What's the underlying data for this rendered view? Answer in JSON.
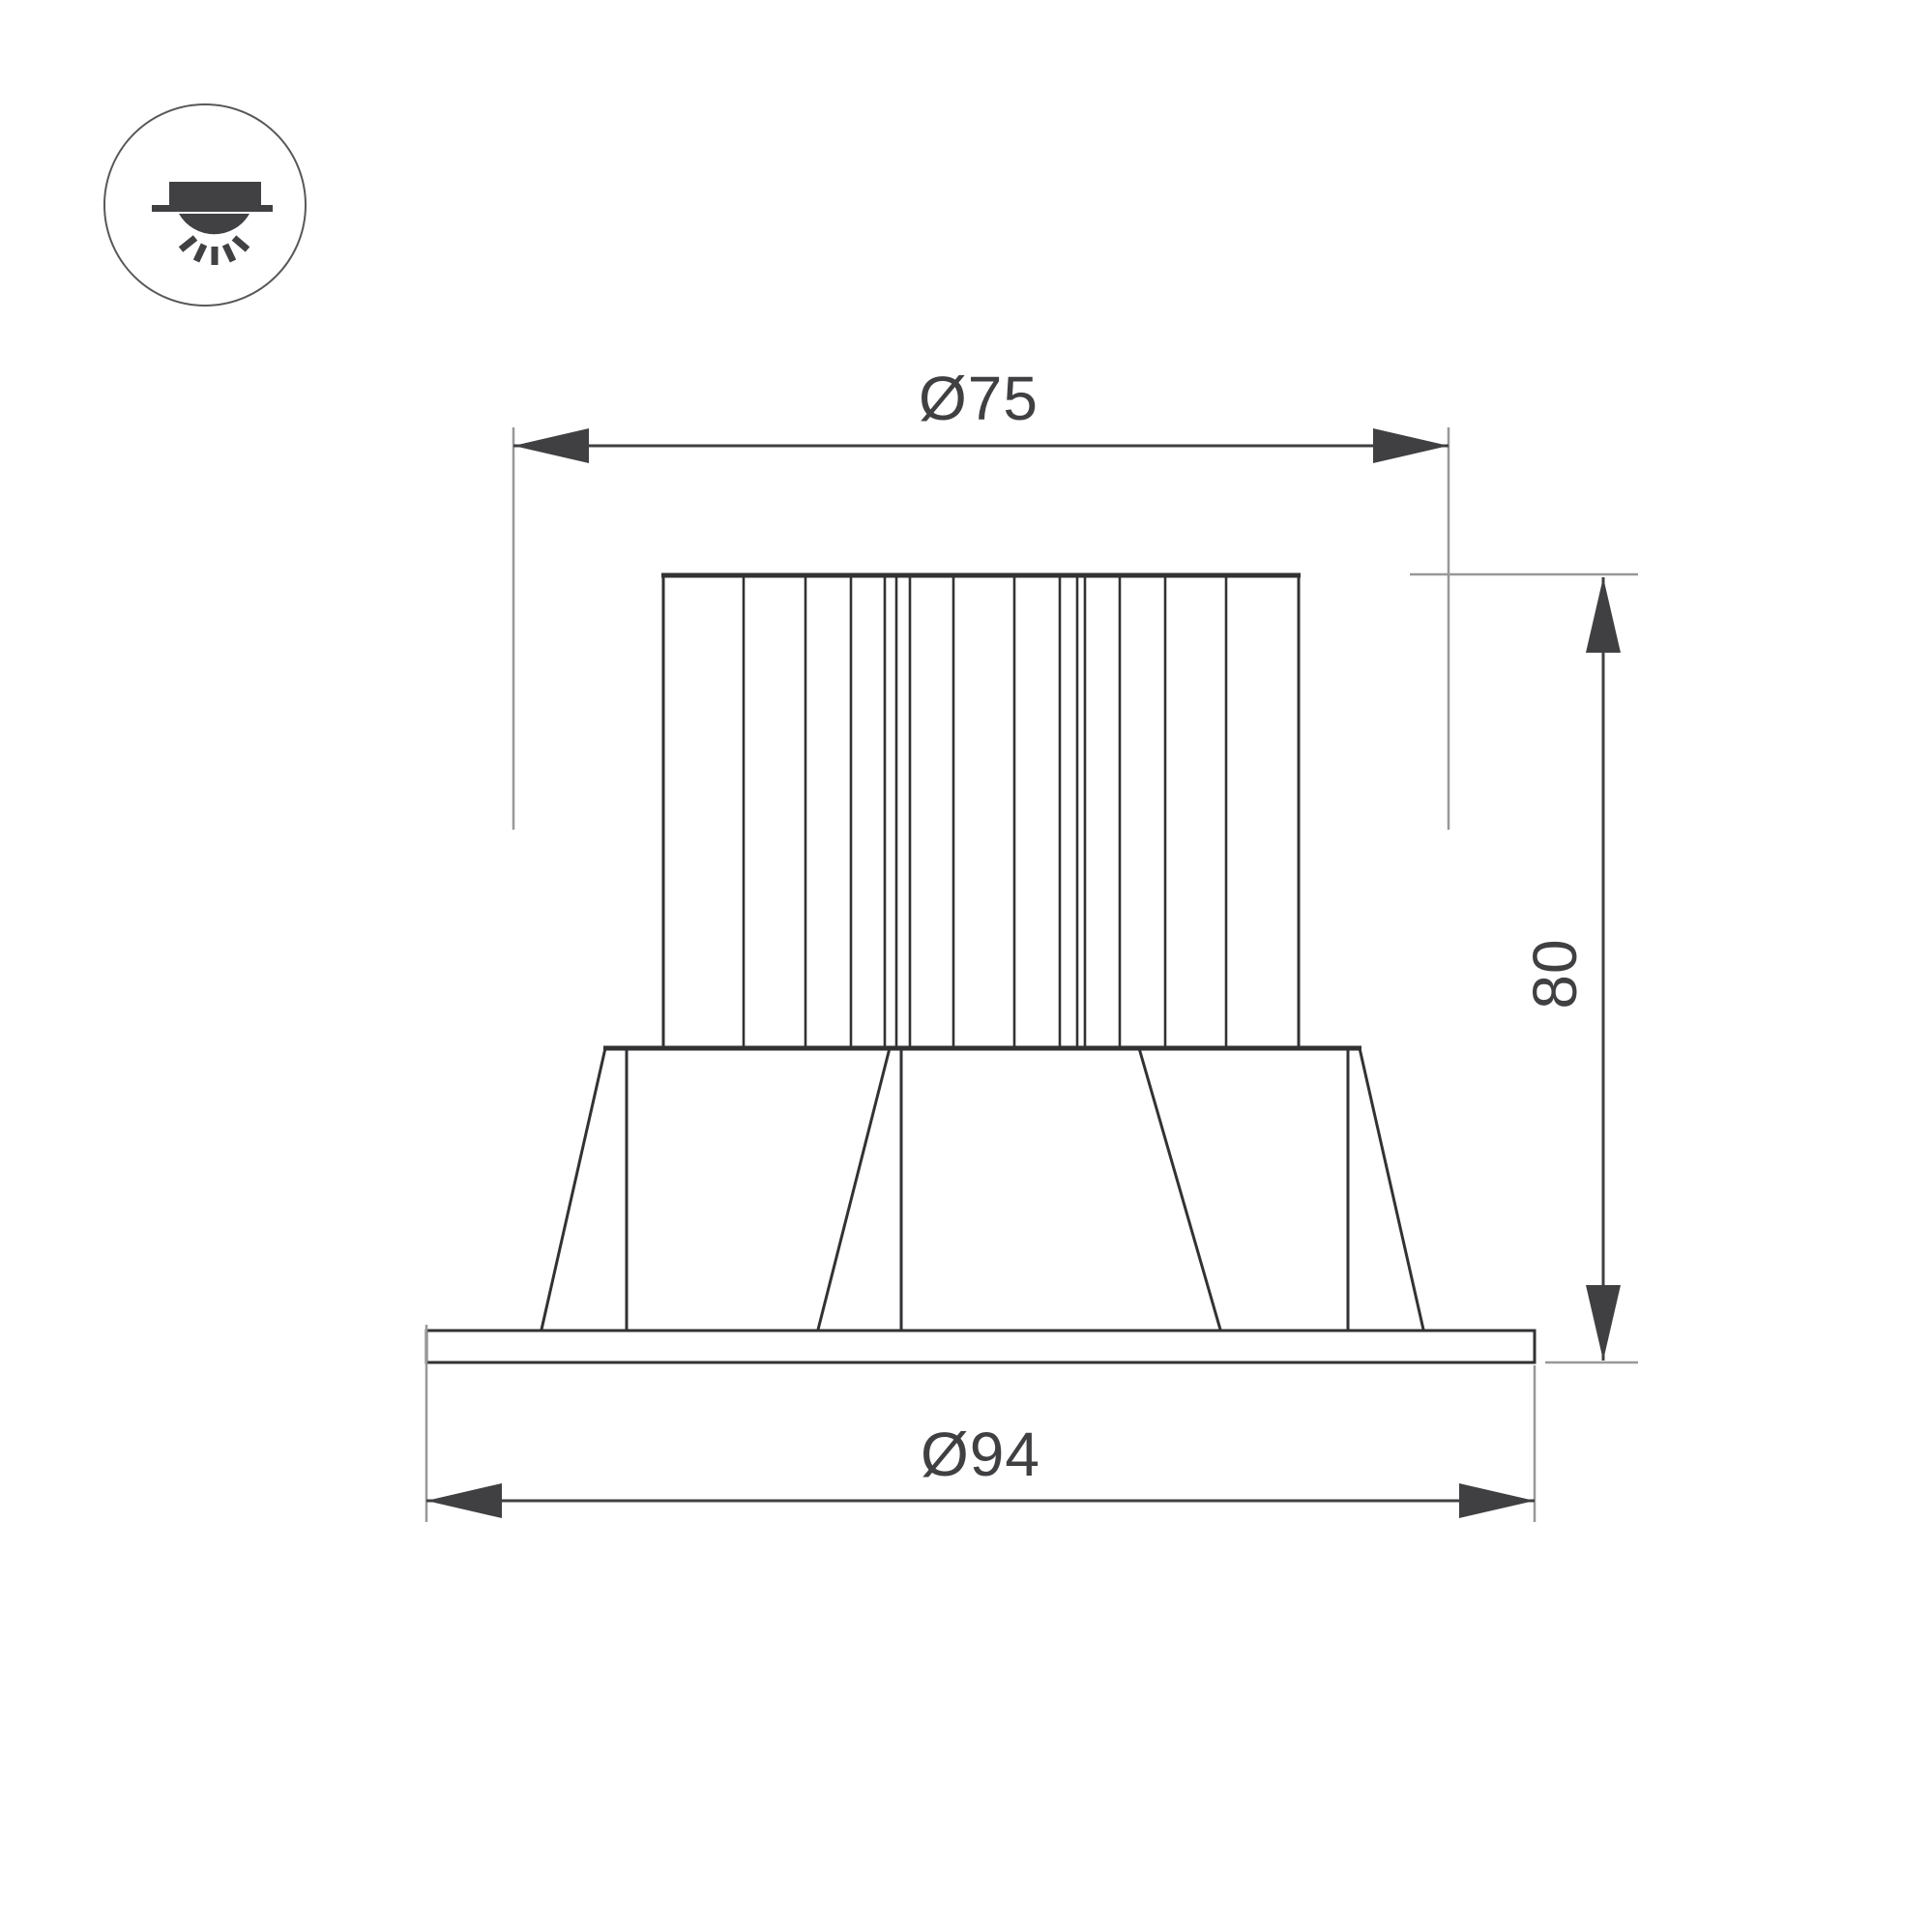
{
  "drawing": {
    "kind": "dimension-drawing",
    "dimensions": {
      "top_diameter": "Ø75",
      "height": "80",
      "bottom_diameter": "Ø94"
    }
  },
  "icon": {
    "name": "recessed-downlight-icon"
  },
  "colors": {
    "background": "#ffffff",
    "object_line": "#323234",
    "dimension": "#404043",
    "extension_line": "#98989a",
    "icon_fill": "#414144",
    "icon_ring": "#58585a"
  }
}
